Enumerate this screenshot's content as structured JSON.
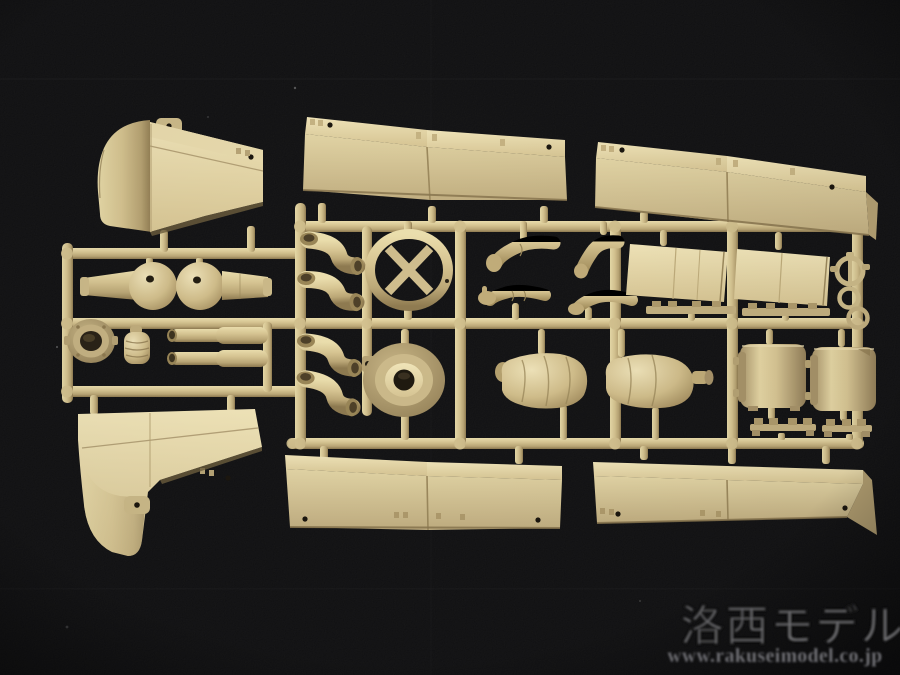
{
  "meta": {
    "domain": "natural-image",
    "description": "Photograph of a sand-tan injection-molded plastic model kit sprue (parts runner) of tank accessory and crew-figure parts, laid on a black cloth background, with shop watermark in lower right."
  },
  "watermark": {
    "brand": "洛西モデル",
    "url": "www.rakuseimodel.co.jp",
    "text_color": "#8d8d91"
  },
  "palette": {
    "background": "#0c0c0e",
    "plastic_light": "#eee2b6",
    "plastic_mid": "#d6c493",
    "plastic_deep": "#b3a070",
    "plastic_shadow": "#7c6b47",
    "hole_dark": "#1c170f"
  },
  "sprue": {
    "color_name": "sand tan / dark yellow",
    "part_names": [
      "front-fender-upper-left",
      "side-skirt-pair-top-center",
      "side-skirt-pair-top-right",
      "ball-socket-mount-left",
      "ball-socket-mount-right",
      "turret-ring-collar",
      "ribbed-cap",
      "exhaust-pipe-upper",
      "exhaust-pipe-lower",
      "exhaust-elbows-x4",
      "cross-brace-ring",
      "hub-drum",
      "crew-arm-fist",
      "crew-arm-bent",
      "crew-arm-open-hand",
      "crew-arm-sleeve",
      "hatch-panel-left",
      "hatch-panel-right",
      "hinge-rail-left",
      "hinge-rail-right",
      "hand-wheel",
      "tow-ring-upper",
      "tow-ring-lower",
      "crew-torso-jacket",
      "crew-torso-plain",
      "seat-drum-left",
      "seat-drum-right",
      "bracket-rail-left",
      "bracket-rail-right",
      "front-fender-lower-left",
      "side-skirt-pair-bottom-center",
      "side-skirt-pair-bottom-right",
      "sprue-runner-frame"
    ]
  }
}
